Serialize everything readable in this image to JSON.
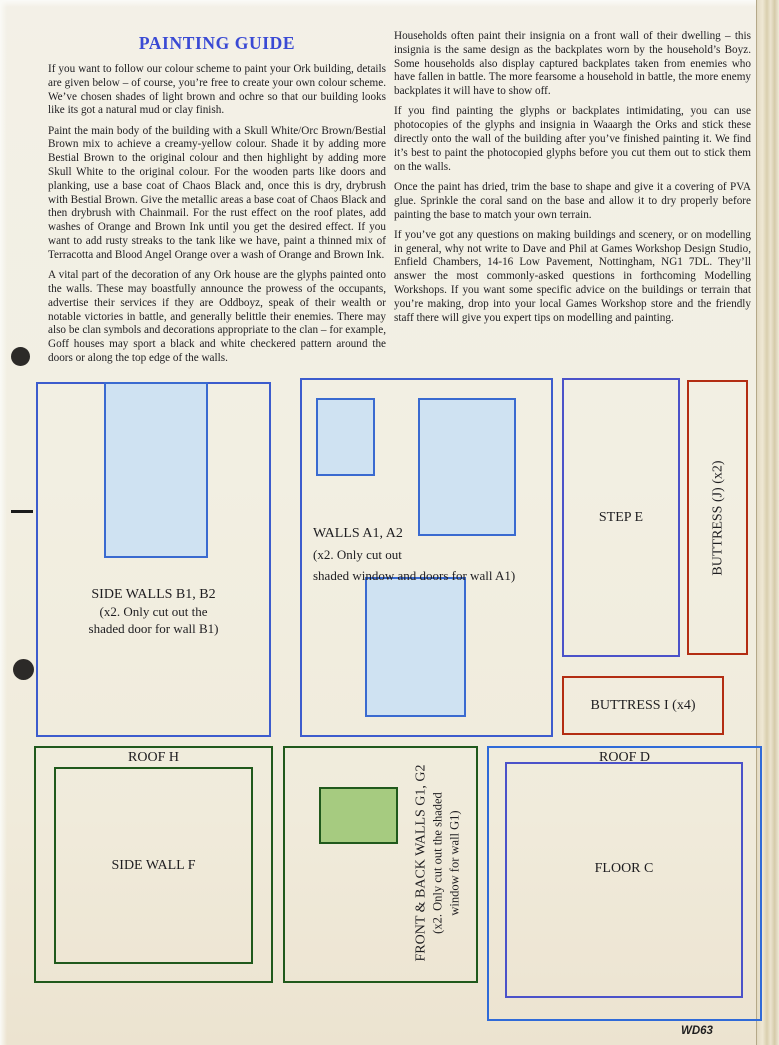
{
  "colors": {
    "title_blue": "#3a4ad4",
    "blue_outline": "#3d5ccd",
    "light_blue_fill": "#cfe2f2",
    "violet_blue": "#4b52c9",
    "roof_d_blue": "#2f6ad8",
    "red_outline": "#b32d12",
    "green_outline": "#20591c",
    "green_fill": "#a6cb80",
    "page_bg": "#f2efe2"
  },
  "article": {
    "title": "PAINTING GUIDE",
    "left_paragraphs": [
      "If you want to follow our colour scheme to paint your Ork building, details are given below – of course, you’re free to create your own colour scheme. We’ve chosen shades of light brown and ochre so that our building looks like its got a natural mud or clay finish.",
      "Paint the main body of the building with a Skull White/Orc Brown/Bestial Brown mix to achieve a creamy-yellow colour. Shade it by adding more Bestial Brown to the original colour and then highlight by adding more Skull White to the original colour. For the wooden parts like doors and planking, use a base coat of Chaos Black and, once this is dry, drybrush with Bestial Brown. Give the metallic areas a base coat of Chaos Black and then drybrush with Chainmail. For the rust effect on the roof plates, add washes of Orange and Brown Ink until you get the desired effect. If you want to add rusty streaks to the tank like we have, paint a thinned mix of Terracotta and Blood Angel Orange over a wash of Orange and Brown Ink.",
      "A vital part of the decoration of any Ork house are the glyphs painted onto the walls. These may boastfully announce the prowess of the occupants, advertise their services if they are Oddboyz, speak of their wealth or notable victories in battle, and generally belittle their enemies. There may also be clan symbols and decorations appropriate to the clan – for example, Goff houses may sport a black and white checkered pattern around the doors or along the top edge of the walls."
    ],
    "right_paragraphs": [
      "Households often paint their insignia on a front wall of their dwelling – this insignia is the same design as the backplates worn by the household’s Boyz. Some households also display captured backplates taken from enemies who have fallen in battle. The more fearsome a household in battle, the more enemy backplates it will have to show off.",
      "If you find painting the glyphs or backplates intimidating, you can use photocopies of the glyphs and insignia in Waaargh the Orks and stick these directly onto the wall of the building after you’ve finished painting it. We find it’s best to paint the photocopied glyphs before you cut them out to stick them on the walls.",
      "Once the paint has dried, trim the base to shape and give it a covering of PVA glue. Sprinkle the coral sand on the base and allow it to dry properly before painting the base to match your own terrain.",
      "If you’ve got any questions on making buildings and scenery, or on modelling in general, why not write to Dave and Phil at Games Workshop Design Studio, Enfield Chambers, 14-16 Low Pavement, Nottingham, NG1 7DL. They’ll answer the most commonly-asked questions in forthcoming Modelling Workshops. If you want some specific advice on the buildings or terrain that you’re making, drop into your local Games Workshop store and the friendly staff there will give you expert tips on modelling and painting."
    ]
  },
  "templates": {
    "side_walls": {
      "lines": [
        "SIDE WALLS B1, B2",
        "(x2. Only cut out the",
        "shaded door for wall B1)"
      ]
    },
    "walls_a": {
      "lines": [
        "WALLS A1, A2",
        "(x2. Only cut out",
        "shaded window and doors for wall A1)"
      ]
    },
    "step_e": {
      "label": "STEP E"
    },
    "buttress_j": {
      "label": "BUTTRESS (J) (x2)"
    },
    "buttress_i": {
      "label": "BUTTRESS I (x4)"
    },
    "roof_h": {
      "label": "ROOF H"
    },
    "side_wall_f": {
      "label": "SIDE WALL F"
    },
    "walls_g": {
      "lines": [
        "FRONT & BACK WALLS G1, G2",
        "(x2. Only cut out the shaded",
        "window for wall G1)"
      ]
    },
    "roof_d": {
      "label": "ROOF D"
    },
    "floor_c": {
      "label": "FLOOR C"
    }
  },
  "footer": {
    "code": "WD63"
  }
}
